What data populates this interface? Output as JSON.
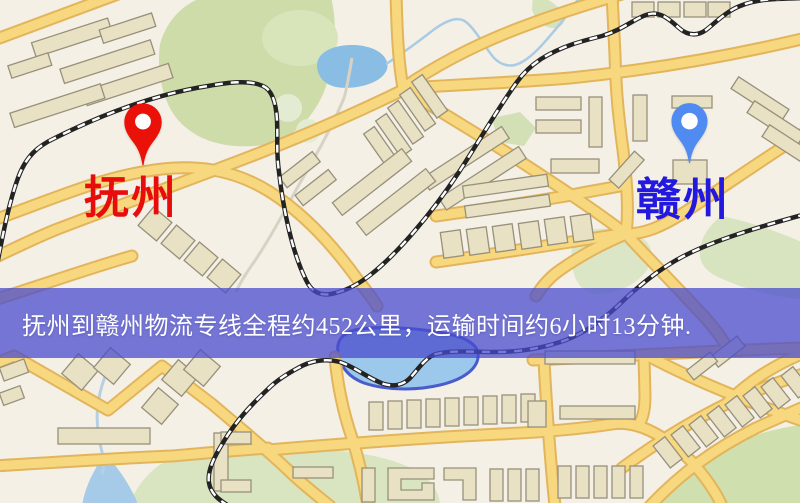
{
  "route_map": {
    "origin": {
      "name": "抚州",
      "label_color": "#e70d0d",
      "pin_color": "#ea1208",
      "pin_icon": "red-map-pin"
    },
    "destination": {
      "name": "赣州",
      "label_color": "#2318dd",
      "pin_color": "#4f8bf0",
      "pin_icon": "blue-map-pin"
    }
  },
  "banner": {
    "text": "抚州到赣州物流专线全程约452公里，运输时间约6小时13分钟.",
    "background_color": "#4a4ccd",
    "text_color": "#ffffff"
  },
  "route_details": {
    "distance_text": "约452公里",
    "duration_text": "约6小时13分钟"
  },
  "map_colors": {
    "background": "#f4f0e6",
    "road_fill": "#f8d87e",
    "road_casing": "#e2b55c",
    "building_fill": "#e9e1c3",
    "building_outline": "#97907b",
    "green_area": "#cddca9",
    "water": "#8abde4",
    "railway": "#222222"
  }
}
